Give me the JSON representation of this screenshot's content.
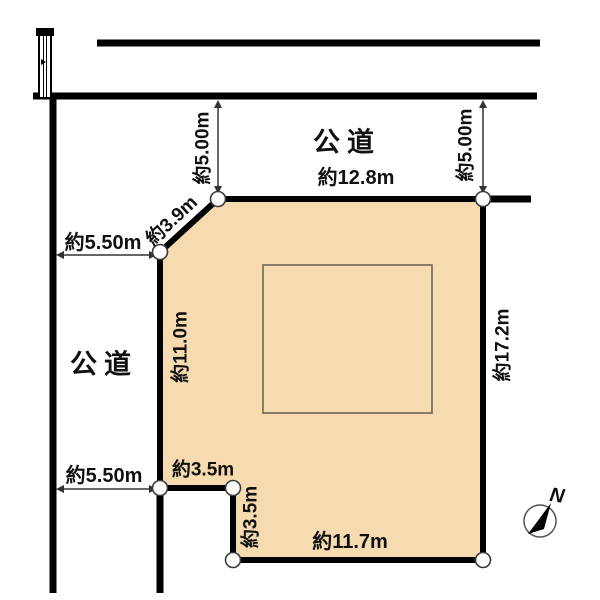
{
  "diagram": {
    "type": "land-plot-layout",
    "colors": {
      "background": "#ffffff",
      "parcel_fill": "#f7dbb0",
      "boundary": "#000000",
      "dimension_line": "#333333",
      "footprint_stroke": "#6f6453",
      "vertex_stroke": "#3a3a3a"
    },
    "roads": {
      "top_label": "公道",
      "left_label": "公道"
    },
    "dimensions": {
      "top_edge": "約12.8m",
      "diagonal_edge": "約3.9m",
      "left_edge": "約11.0m",
      "right_edge": "約17.2m",
      "bottom_edge": "約11.7m",
      "notch_top": "約3.5m",
      "notch_side": "約3.5m",
      "top_road_width_left": "約5.00m",
      "top_road_width_right": "約5.00m",
      "left_road_width_upper": "約5.50m",
      "left_road_width_lower": "約5.50m"
    },
    "compass": {
      "north_label": "N"
    },
    "icons": [
      "utility-pole-icon",
      "compass-icon"
    ]
  }
}
